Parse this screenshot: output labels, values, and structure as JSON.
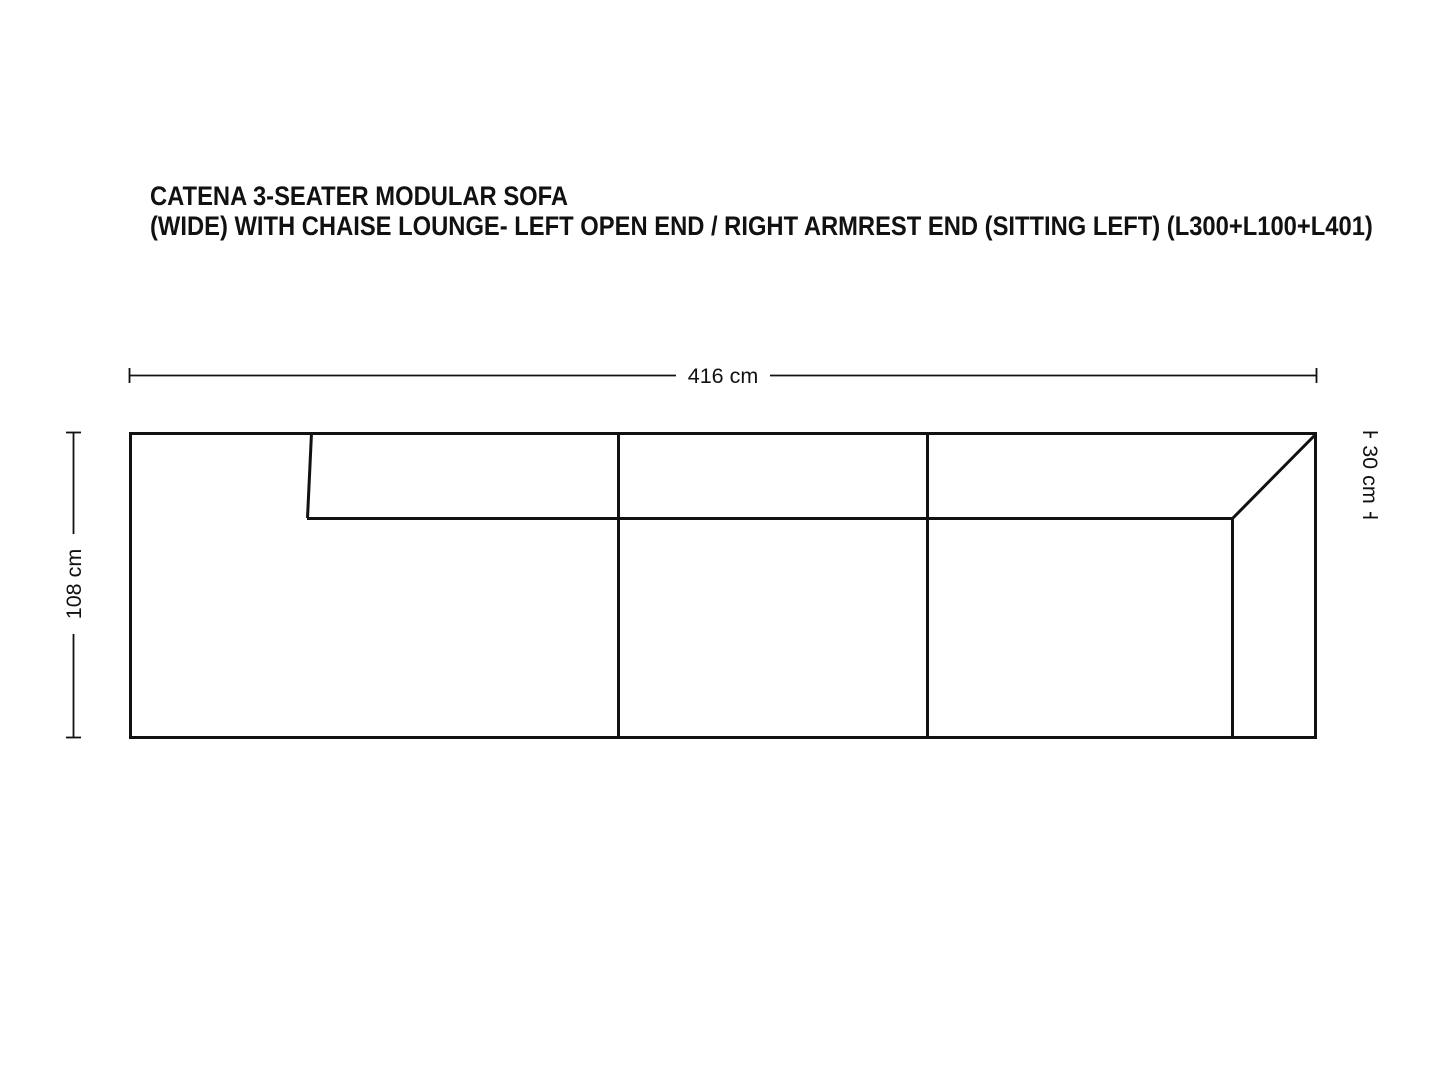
{
  "title": {
    "line1": "CATENA 3-SEATER MODULAR SOFA",
    "line2": "(WIDE) WITH CHAISE LOUNGE- LEFT OPEN END / RIGHT ARMREST END (SITTING LEFT) (L300+L100+L401)"
  },
  "dimensions": {
    "overall_width": "416 cm",
    "overall_depth": "108 cm",
    "armrest_width": "30 cm"
  },
  "colors": {
    "line": "#111111",
    "text": "#111111",
    "background": "#ffffff"
  }
}
